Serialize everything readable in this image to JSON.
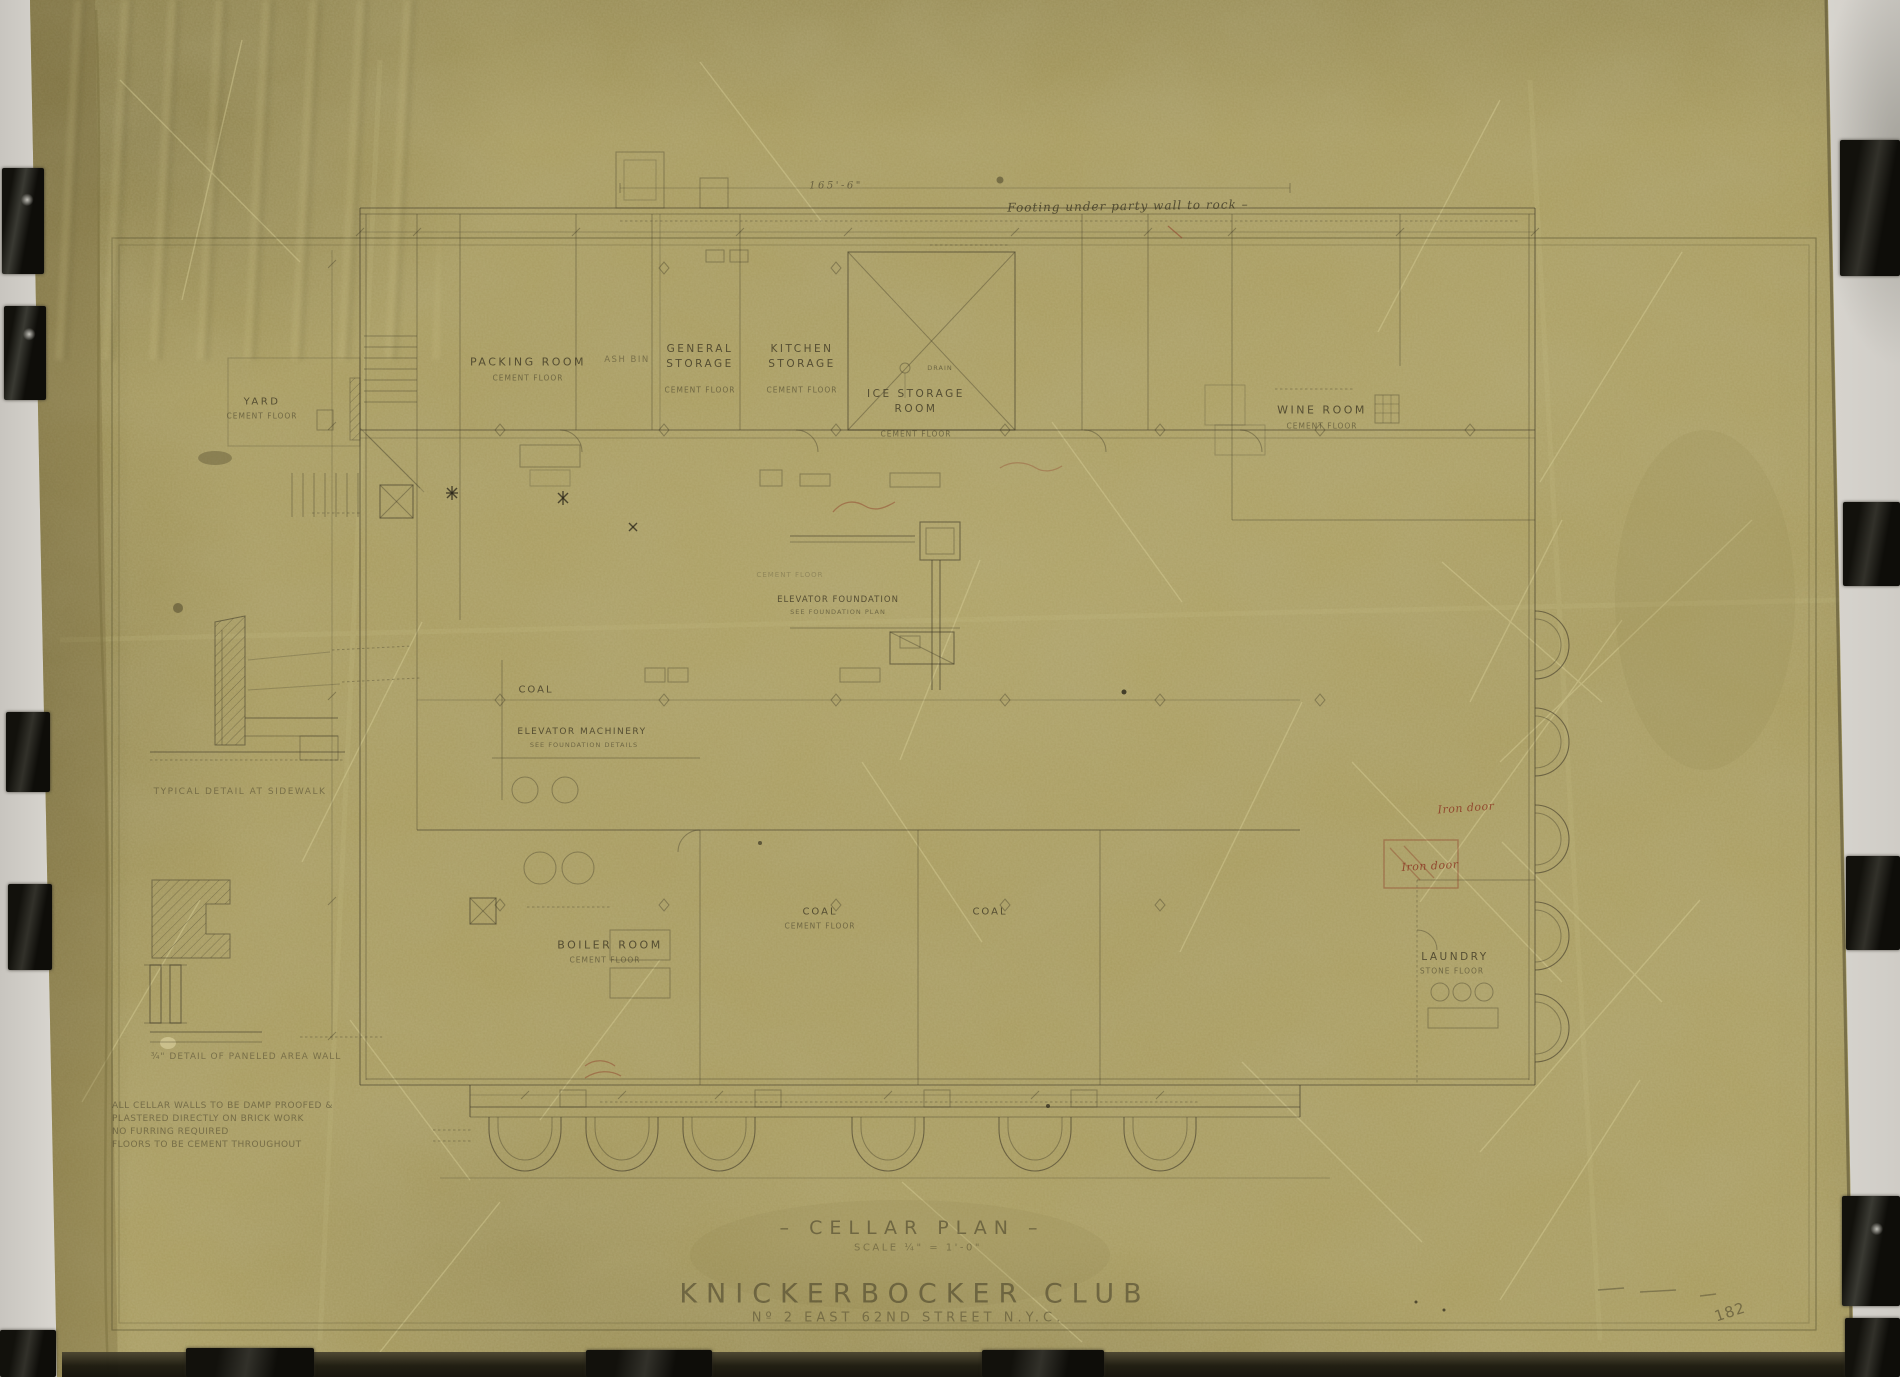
{
  "document": {
    "kind": "Photographed architectural linen drawing — cellar floor plan",
    "title": "– CELLAR PLAN –",
    "scale_note": "SCALE  ¼\" = 1'-0\"",
    "project_name": "KNICKERBOCKER CLUB",
    "project_address": "Nº 2 EAST 62ND STREET N.Y.C.",
    "sheet_number": "182",
    "top_annotation": "Footing under party wall to rock –",
    "overall_dimension": "165'-6\""
  },
  "rooms": [
    {
      "name": "YARD",
      "floor": "CEMENT FLOOR"
    },
    {
      "name": "PACKING ROOM",
      "floor": "CEMENT FLOOR"
    },
    {
      "name": "ASH BIN",
      "floor": ""
    },
    {
      "name": "GENERAL STORAGE",
      "floor": "CEMENT FLOOR"
    },
    {
      "name": "KITCHEN STORAGE",
      "floor": "CEMENT FLOOR"
    },
    {
      "name": "ICE STORAGE ROOM",
      "floor": "CEMENT FLOOR"
    },
    {
      "name": "WINE ROOM",
      "floor": "CEMENT FLOOR"
    },
    {
      "name": "COAL",
      "floor": ""
    },
    {
      "name": "ELEVATOR MACHINERY",
      "floor": "SEE FOUNDATION DETAILS"
    },
    {
      "name": "ELEVATOR FOUNDATION",
      "floor": "SEE FOUNDATION PLAN"
    },
    {
      "name": "CEMENT FLOOR",
      "floor": ""
    },
    {
      "name": "BOILER ROOM",
      "floor": "CEMENT FLOOR"
    },
    {
      "name": "COAL",
      "floor": "CEMENT FLOOR"
    },
    {
      "name": "COAL",
      "floor": ""
    },
    {
      "name": "LAUNDRY",
      "floor": "STONE FLOOR"
    },
    {
      "name": "DRAIN",
      "floor": ""
    }
  ],
  "details": {
    "caption_sidewalk": "TYPICAL DETAIL AT SIDEWALK",
    "caption_area_wall": "¾\" DETAIL OF PANELED AREA WALL"
  },
  "notes": {
    "line1": "ALL CELLAR WALLS TO BE DAMP PROOFED &",
    "line2": "PLASTERED DIRECTLY ON BRICK WORK",
    "line3": "NO FURRING REQUIRED",
    "line4": "FLOORS TO BE CEMENT THROUGHOUT"
  },
  "red_annotations": {
    "iron_door_1": "Iron door",
    "iron_door_2": "Iron door"
  },
  "colors": {
    "sheet": "#a89b5e",
    "pencil": "#3f3a28",
    "red_ink": "#8e3a26",
    "tape": "#15130c",
    "backdrop": "#e4e1db"
  }
}
